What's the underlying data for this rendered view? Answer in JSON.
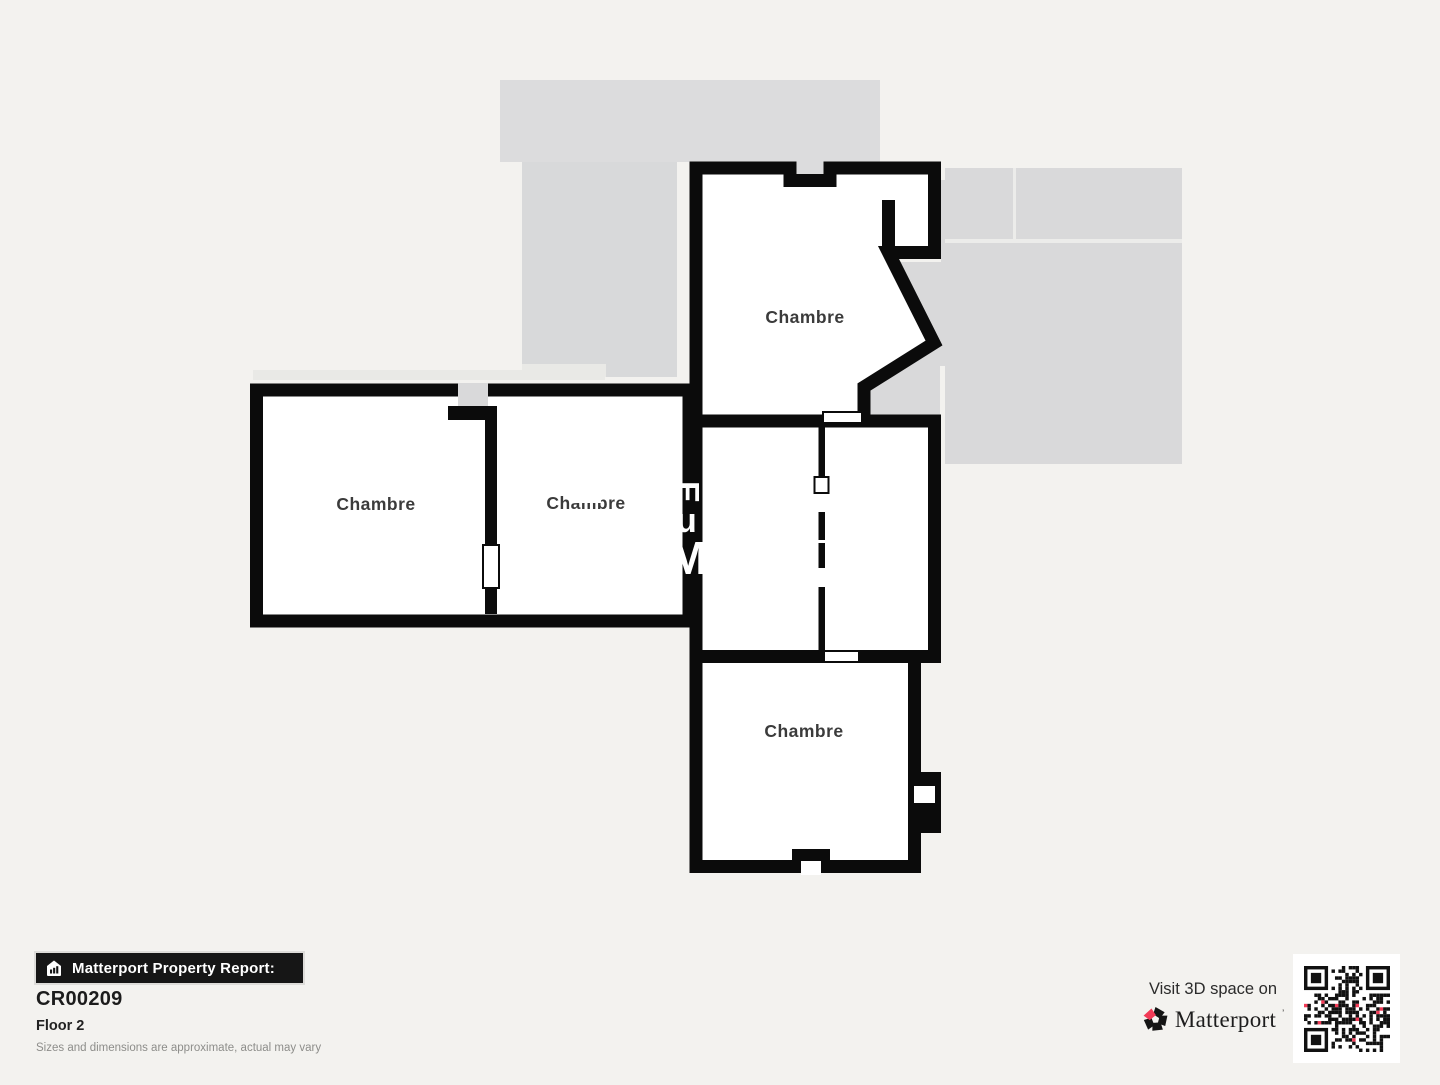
{
  "floor_plan": {
    "rooms": [
      {
        "label": "Chambre",
        "position": "top"
      },
      {
        "label": "Chambre",
        "position": "left"
      },
      {
        "label": "Chambre",
        "position": "center-left"
      },
      {
        "label": "Chambre",
        "position": "bottom"
      }
    ],
    "watermark_fragments": [
      "E",
      "u",
      "M"
    ],
    "colors": {
      "wall": "#0b0b0b",
      "room_fill": "#ffffff",
      "label": "#3b3b3b",
      "adjacent_gray": "#d9d9da",
      "adjacent_gray_light": "#e9e9e6",
      "background": "#f3f2ef"
    }
  },
  "footer": {
    "report_banner": {
      "icon": "house-chart-icon",
      "label": "Matterport Property Report:"
    },
    "property_id": "CR00209",
    "floor_label": "Floor 2",
    "disclaimer": "Sizes and dimensions are approximate, actual may vary"
  },
  "cta": {
    "visit_text": "Visit 3D space on",
    "brand": "Matterport",
    "trademark": "’",
    "logo_icon": "matterport-pinwheel-icon",
    "qr_icon": "qr-code",
    "brand_accent": "#f23b57",
    "qr": {
      "modules": 25,
      "pink_color": "#f23b57",
      "dark_color": "#111111"
    }
  }
}
